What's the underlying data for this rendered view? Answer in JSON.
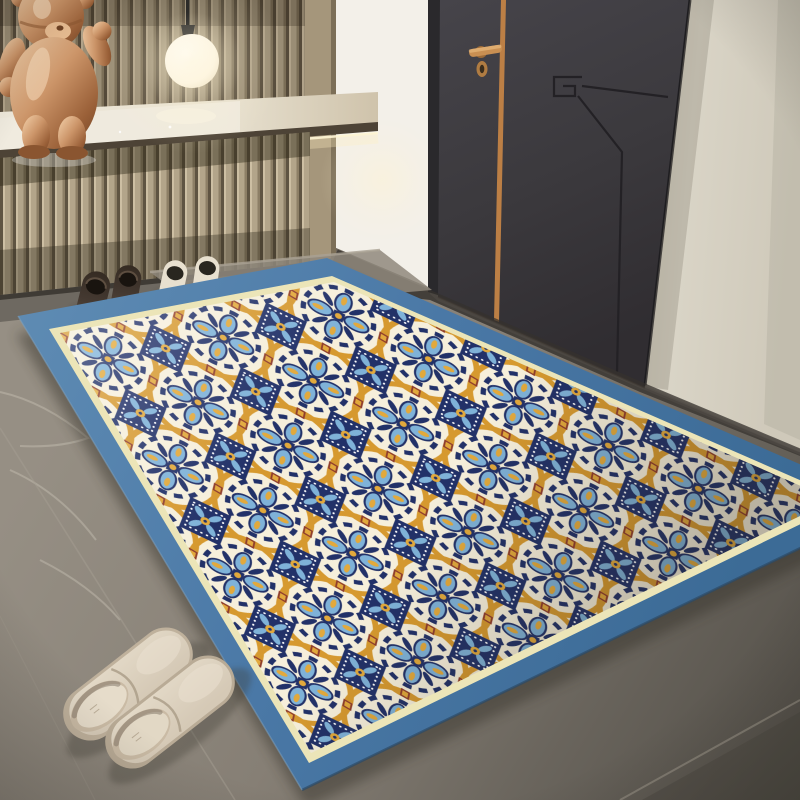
{
  "scene": {
    "type": "interior-product-photo",
    "subject": "blue-bordered moroccan tile pattern entry mat in a hallway",
    "setting": "entryway with wood slat wall, floating shelf, pendant lamp, charcoal door, stone floor"
  },
  "elements": {
    "wall": "vertical wood slat paneling",
    "shelf": "floating stone-top console with under-shelf light",
    "sculpture": "polished copper teddy-bear figurine",
    "lamp": "glowing white globe pendant on dark cord",
    "door": "charcoal flush door with copper inlay stripe, copper lever handle, oval keyhole and engraved line motif",
    "right_wall": "warm greige plaster wall",
    "shoes_pair_1": "dark brown loafers",
    "shoes_pair_2": "cream slip-on shoes with black collars",
    "slippers": "beige mule slippers",
    "floor": "gray concrete-look stone tiles with thin grout lines",
    "rug": {
      "border": "wide steel blue band",
      "inner_trim": "thin pale yellow line",
      "field": "cream",
      "pattern": "interlocking orange circle rings, navy diamonds with white dotted edges, light blue four-petal flowers, orange teardrops, maroon accents"
    }
  },
  "palette": {
    "rug-border-a": "#5e8bb3",
    "rug-border-b": "#3c6b96",
    "rug-trim": "#ece5b8",
    "rug-cream": "#f6efdb",
    "rug-navy": "#223168",
    "rug-lightblue": "#7fb2d8",
    "rug-orange": "#d6992f",
    "rug-orange2": "#e2a93c",
    "rug-maroon": "#8e3b2c",
    "door-color": "#3b393d",
    "door-frame": "#2a292c",
    "copper": "#bc7f45",
    "greige-wall": "#d9d4c6",
    "niche-wall": "#f3f0e9",
    "slat-face": "#b3a58a",
    "slat-gap": "#5f5442",
    "counter": "#e7e0cf",
    "bear-bronze": "#cb9468",
    "lamp-glow": "#fff3d2",
    "floor-light": "#968f84",
    "floor-dark": "#56524b",
    "shoe-dark": "#443931",
    "shoe-cream": "#e8e0cf",
    "slipper-beige": "#d5c9b6"
  }
}
